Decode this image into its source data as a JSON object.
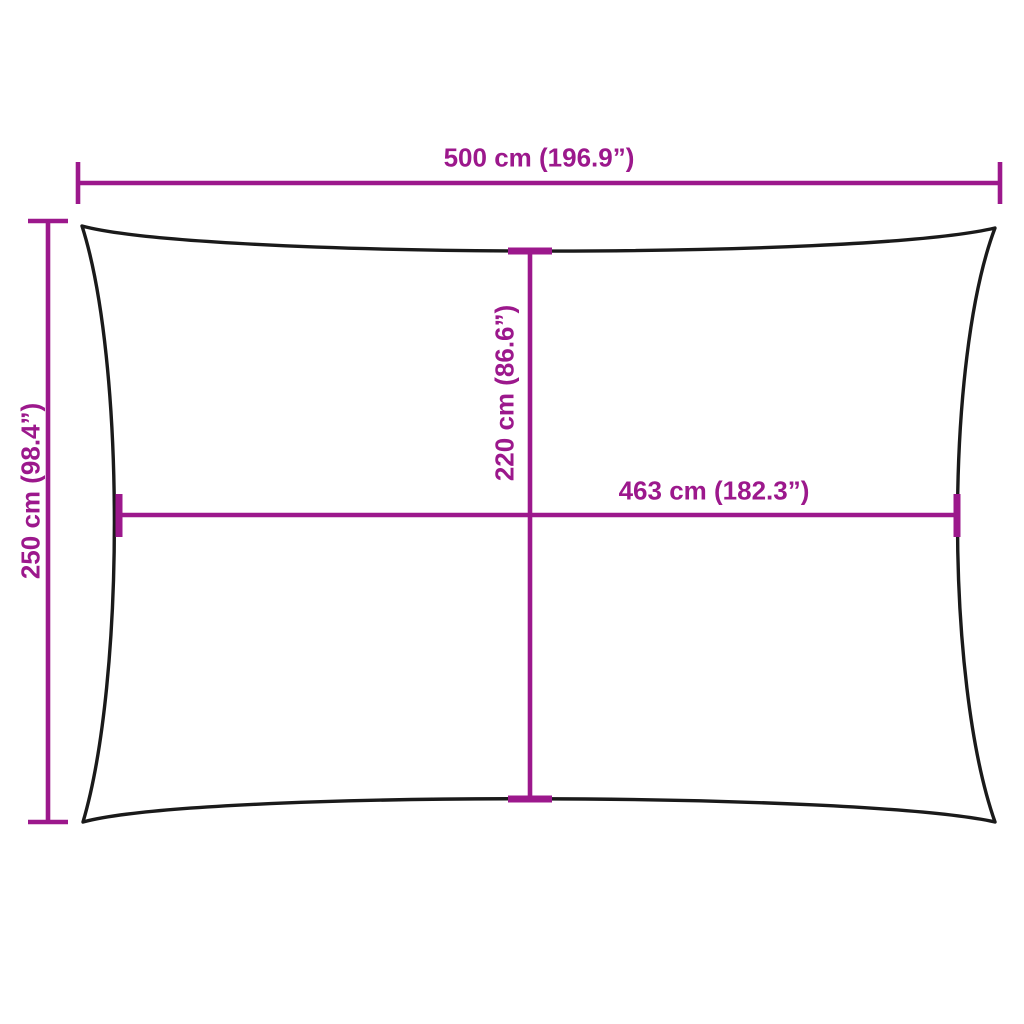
{
  "labels": {
    "width_total": "500 cm (196.9”)",
    "height_total": "250 cm (98.4”)",
    "inner_height": "220 cm (86.6”)",
    "inner_width": "463 cm (182.3”)"
  },
  "colors": {
    "dimension": "#9C188C",
    "outline": "#1A1A1A",
    "background": "#FFFFFF"
  }
}
